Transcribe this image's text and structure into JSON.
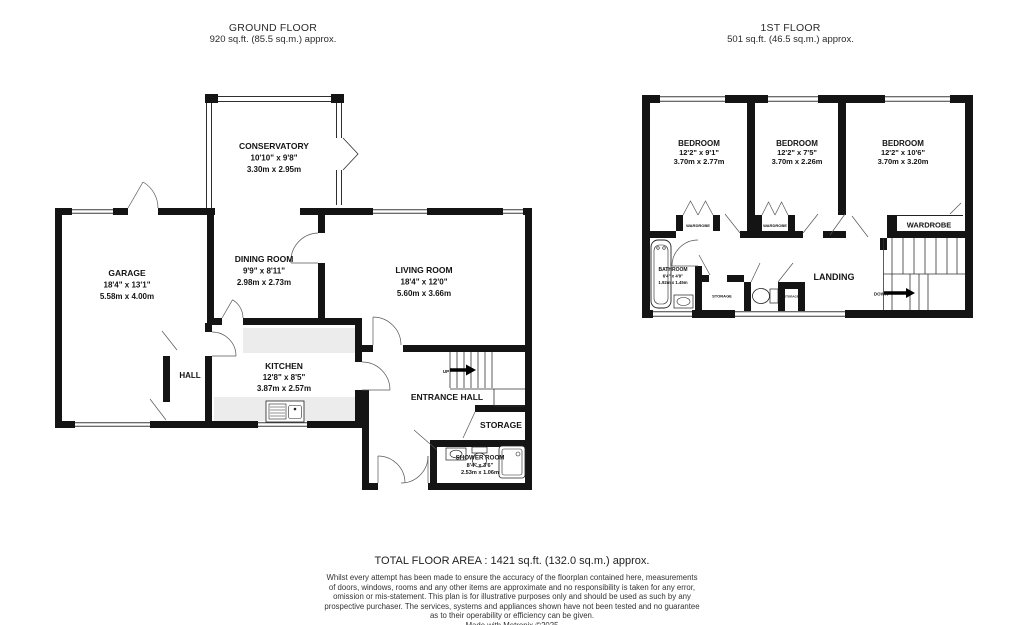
{
  "ground_floor": {
    "title": "GROUND FLOOR",
    "area": "920 sq.ft. (85.5 sq.m.) approx.",
    "rooms": {
      "conservatory": {
        "name": "CONSERVATORY",
        "imperial": "10'10\" x 9'8\"",
        "metric": "3.30m x 2.95m"
      },
      "garage": {
        "name": "GARAGE",
        "imperial": "18'4\" x 13'1\"",
        "metric": "5.58m x 4.00m"
      },
      "dining_room": {
        "name": "DINING ROOM",
        "imperial": "9'9\" x 8'11\"",
        "metric": "2.98m x 2.73m"
      },
      "living_room": {
        "name": "LIVING ROOM",
        "imperial": "18'4\" x 12'0\"",
        "metric": "5.60m x 3.66m"
      },
      "kitchen": {
        "name": "KITCHEN",
        "imperial": "12'8\" x 8'5\"",
        "metric": "3.87m x 2.57m"
      },
      "hall": {
        "name": "HALL"
      },
      "entrance_hall": {
        "name": "ENTRANCE HALL"
      },
      "storage": {
        "name": "STORAGE"
      },
      "shower_room": {
        "name": "SHOWER ROOM",
        "imperial": "8'4\" x 3'6\"",
        "metric": "2.53m x 1.06m"
      }
    },
    "stairs": {
      "up_label": "UP"
    }
  },
  "first_floor": {
    "title": "1ST FLOOR",
    "area": "501 sq.ft. (46.5 sq.m.) approx.",
    "rooms": {
      "bedroom_1": {
        "name": "BEDROOM",
        "imperial": "12'2\" x 9'1\"",
        "metric": "3.70m x 2.77m"
      },
      "bedroom_2": {
        "name": "BEDROOM",
        "imperial": "12'2\" x 7'5\"",
        "metric": "3.70m x 2.26m"
      },
      "bedroom_3": {
        "name": "BEDROOM",
        "imperial": "12'2\" x 10'6\"",
        "metric": "3.70m x 3.20m"
      },
      "bathroom": {
        "name": "BATHROOM",
        "imperial": "6'4\" x 4'9\"",
        "metric": "1.92m x 1.45m"
      },
      "landing": {
        "name": "LANDING"
      },
      "wardrobe_1": {
        "name": "WARDROBE"
      },
      "wardrobe_2": {
        "name": "WARDROBE"
      },
      "wardrobe_3": {
        "name": "WARDROBE"
      },
      "storage": {
        "name": "STORAGE"
      },
      "storage_small": {
        "name": "STORAGE"
      }
    },
    "stairs": {
      "down_label": "DOWN"
    }
  },
  "footer": {
    "total_area": "TOTAL FLOOR AREA : 1421 sq.ft. (132.0 sq.m.) approx.",
    "disclaimer_lines": [
      "Whilst every attempt has been made to ensure the accuracy of the floorplan contained here, measurements",
      "of doors, windows, rooms and any other items are approximate and no responsibility is taken for any error,",
      "omission or mis-statement. This plan is for illustrative purposes only and should be used as such by any",
      "prospective purchaser. The services, systems and appliances shown have not been tested and no guarantee",
      "as to their operability or efficiency can be given."
    ],
    "credit": "Made with Metropix ©2025"
  },
  "colors": {
    "wall": "#141414",
    "counter": "#ececec",
    "door_line": "#555555",
    "text": "#141414"
  }
}
